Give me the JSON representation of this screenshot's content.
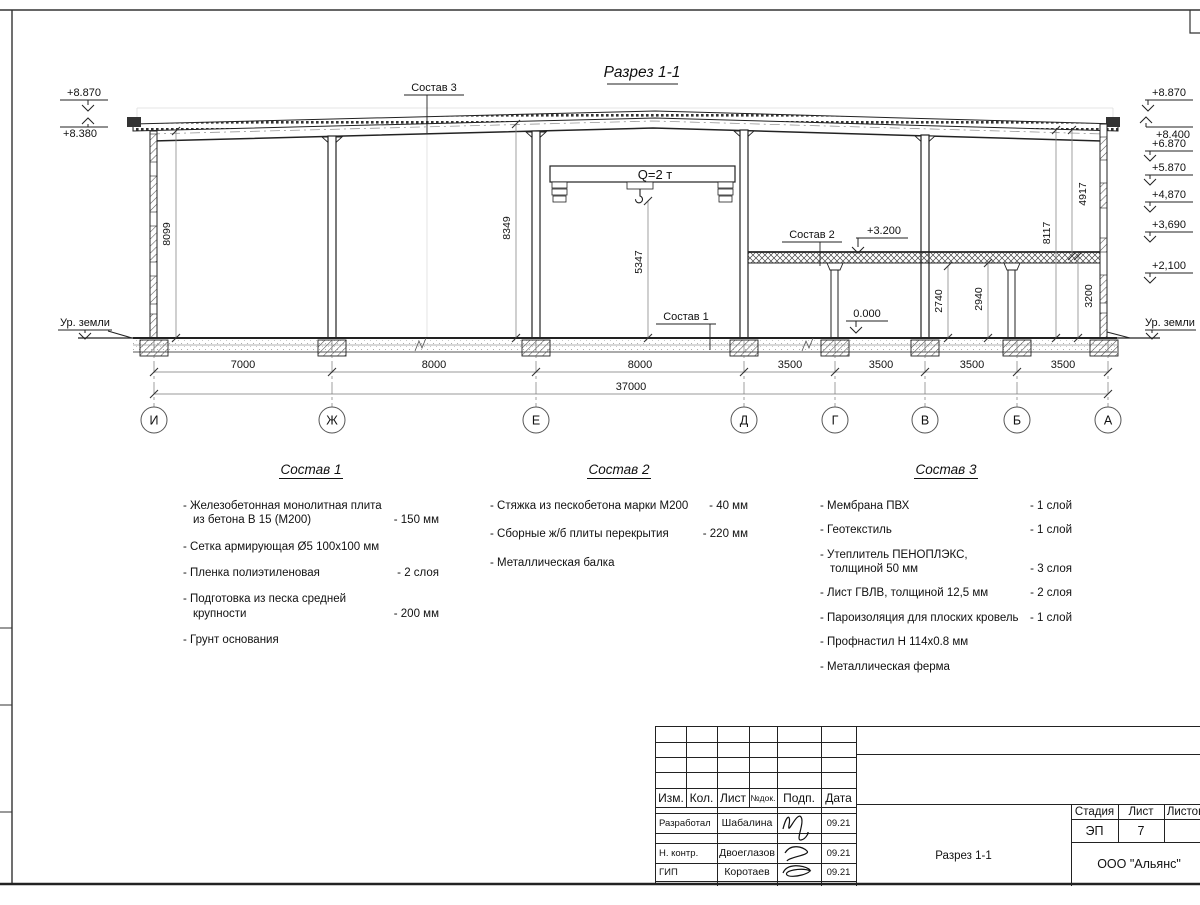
{
  "drawing": {
    "title": "Разрез 1-1",
    "ground_label_left": "Ур. земли",
    "ground_label_right": "Ур. земли",
    "crane_label": "Q=2 т",
    "elev_left": [
      "+8.870",
      "+8.380"
    ],
    "elev_right": [
      "+8.870",
      "+8.400",
      "+6.870",
      "+5.870",
      "+4,870",
      "+3,690",
      "+2,100"
    ],
    "elev_floor2": "+3.200",
    "elev_zero": "0.000",
    "leaders": {
      "s3": "Состав 3",
      "s2": "Состав 2",
      "s1": "Состав 1"
    },
    "vdims": {
      "left_wall": "8099",
      "hall": "8349",
      "crane_hook": "5347",
      "under_beam": "2740",
      "under_slab": "2940",
      "floor2": "3200",
      "right_total": "8117",
      "right_upper": "4917"
    },
    "hdims": {
      "spans": [
        "7000",
        "8000",
        "8000",
        "3500",
        "3500",
        "3500",
        "3500"
      ],
      "total": "37000"
    },
    "axes": [
      "И",
      "Ж",
      "Е",
      "Д",
      "Г",
      "В",
      "Б",
      "А"
    ]
  },
  "lists": {
    "s1": {
      "title": "Состав 1",
      "items": [
        {
          "t": "- Железобетонная  монолитная плита\nиз бетона В 15 (М200)",
          "v": "- 150 мм"
        },
        {
          "t": "- Сетка армирующая Ø5 100х100 мм",
          "v": ""
        },
        {
          "t": "- Пленка полиэтиленовая",
          "v": "- 2 слоя"
        },
        {
          "t": "- Подготовка из песка средней\nкрупности",
          "v": "- 200 мм"
        },
        {
          "t": "- Грунт основания",
          "v": ""
        }
      ]
    },
    "s2": {
      "title": "Состав 2",
      "items": [
        {
          "t": "- Стяжка из пескобетона марки М200",
          "v": "- 40 мм"
        },
        {
          "t": "- Сборные ж/б плиты перекрытия",
          "v": "- 220 мм"
        },
        {
          "t": "- Металлическая балка",
          "v": ""
        }
      ]
    },
    "s3": {
      "title": "Состав 3",
      "items": [
        {
          "t": "- Мембрана ПВХ",
          "v": "- 1 слой"
        },
        {
          "t": "- Геотекстиль",
          "v": "- 1 слой"
        },
        {
          "t": "- Утеплитель ПЕНОПЛЭКС,\nтолщиной 50 мм",
          "v": "- 3 слоя"
        },
        {
          "t": "- Лист ГВЛВ, толщиной 12,5 мм",
          "v": "- 2 слоя"
        },
        {
          "t": "- Пароизоляция для плоских кровель",
          "v": "- 1 слой"
        },
        {
          "t": "- Профнастил Н 114х0.8 мм",
          "v": ""
        },
        {
          "t": "- Металлическая ферма",
          "v": ""
        }
      ]
    }
  },
  "titleblock": {
    "cols": [
      "Изм.",
      "Кол.",
      "Лист",
      "№док.",
      "Подп.",
      "Дата"
    ],
    "rows": [
      {
        "role": "Разработал",
        "name": "Шабалина",
        "date": "09.21"
      },
      {
        "role": "Н. контр.",
        "name": "Двоеглазов",
        "date": "09.21"
      },
      {
        "role": "ГИП",
        "name": "Коротаев",
        "date": "09.21"
      }
    ],
    "stage_label": "Стадия",
    "sheet_label": "Лист",
    "sheets_label": "Листов",
    "stage": "ЭП",
    "sheet_no": "7",
    "doc_name": "Разрез 1-1",
    "company": "ООО \"Альянс\""
  }
}
